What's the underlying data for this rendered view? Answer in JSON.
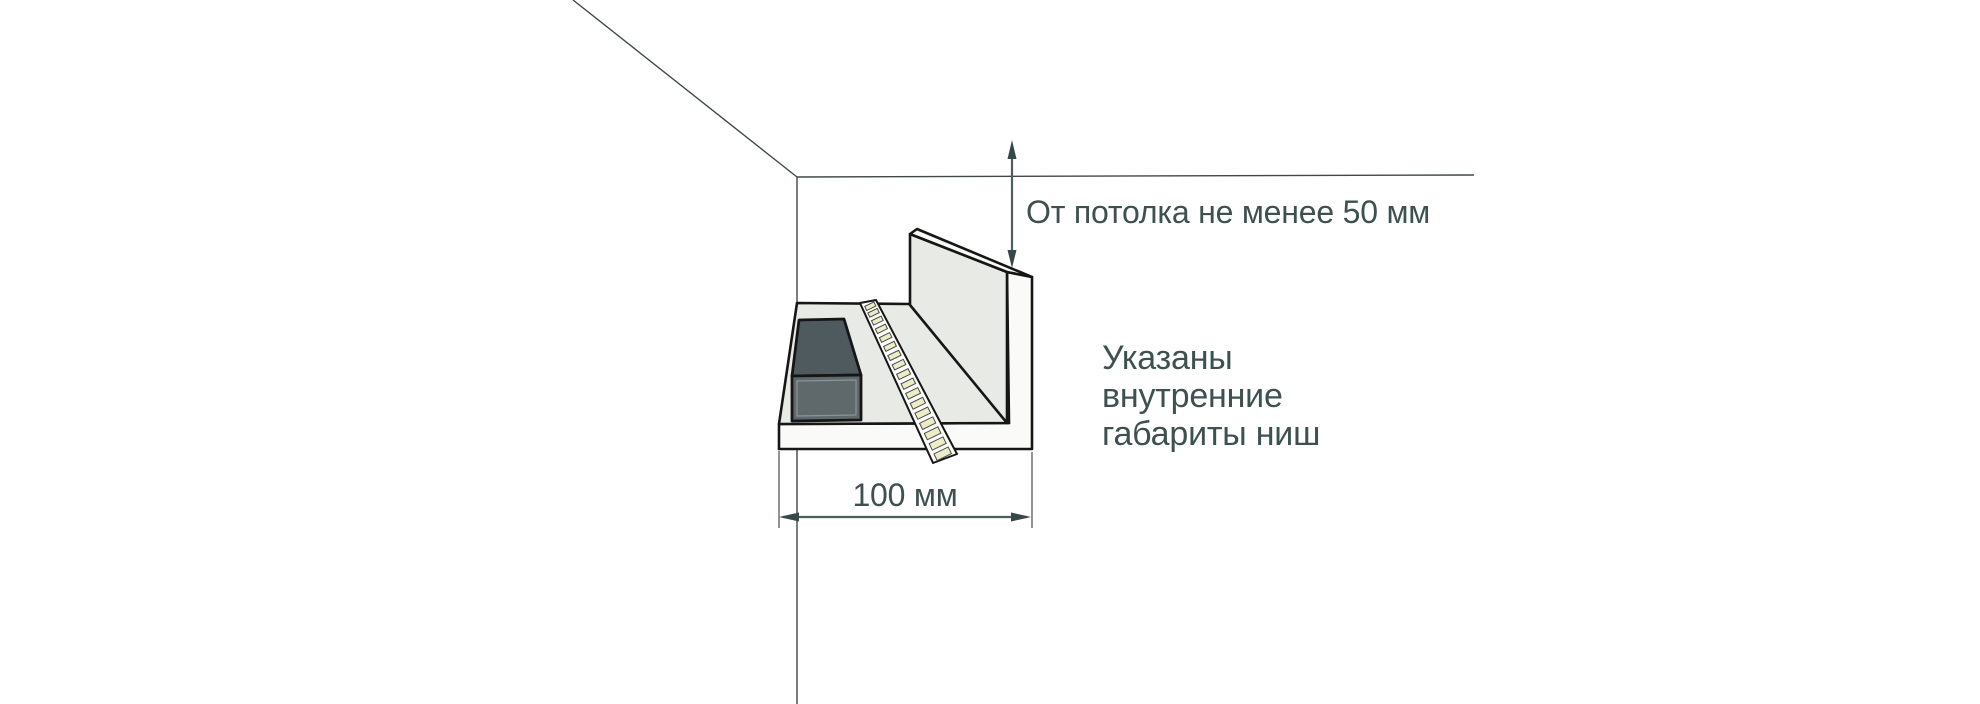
{
  "diagram_title": "LED strip niche mounting diagram",
  "annotations": {
    "ceiling_gap_label": "От потолка не менее 50 мм",
    "niche_width_label": "100 мм",
    "note_lines": [
      "Указаны",
      "внутренние",
      "габариты ниш"
    ]
  },
  "dimensions": {
    "ceiling_gap_min_mm": 50,
    "niche_width_mm": 100
  },
  "led_strip": {
    "led_count": 17
  },
  "colors": {
    "background": "#ffffff",
    "room_line": "#424748",
    "outline": "#161616",
    "surface": "#e7eae5",
    "surface_light": "#fafaf9",
    "driver_top": "#4f5a5e",
    "driver_front": "#5f696c",
    "driver_inner_edge": "#8b9598",
    "strip_base": "#fdfdfc",
    "led_chip": "#ececc6",
    "led_chip_edge": "#4a4a4a",
    "annotation": "#3e504f",
    "dim_shaft": "#4e5d5d",
    "arrowhead": "#37474a",
    "extension_line": "#6f6f6f"
  }
}
